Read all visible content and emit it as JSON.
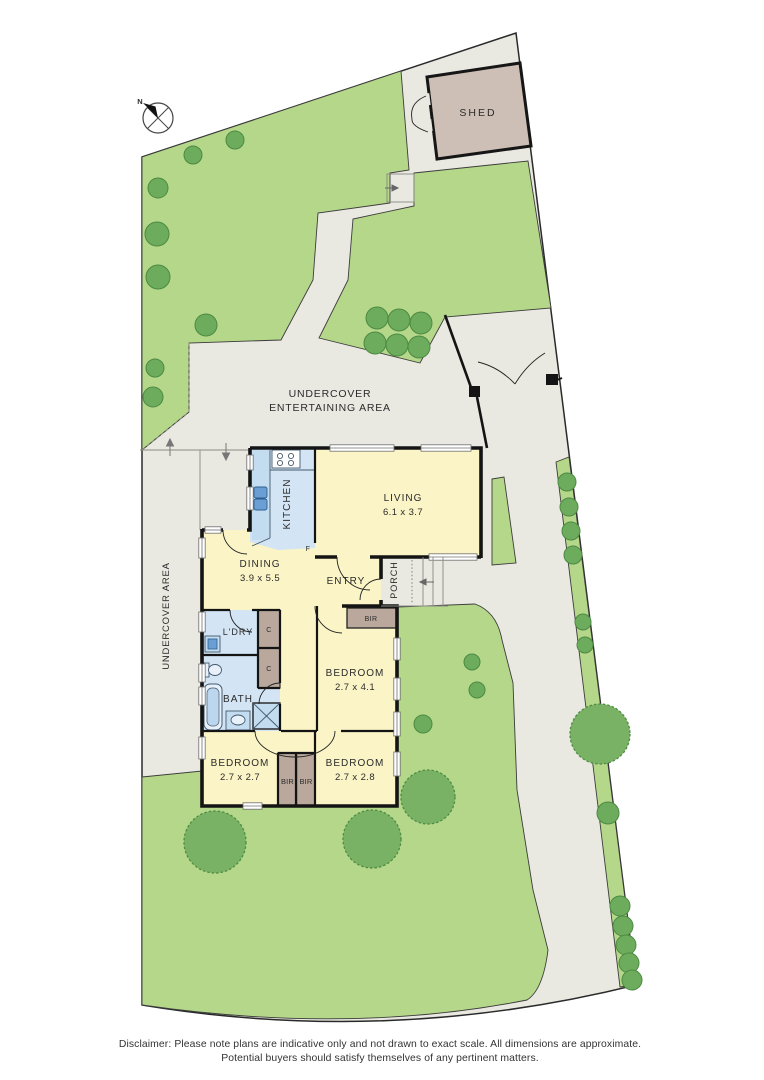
{
  "plan": {
    "compass": {
      "north_label": "N"
    },
    "outdoor": {
      "shed_label": "SHED",
      "entertaining_area_line1": "UNDERCOVER",
      "entertaining_area_line2": "ENTERTAINING AREA",
      "undercover_area_label": "UNDERCOVER AREA",
      "porch_label": "PORCH"
    },
    "rooms": {
      "living": {
        "label": "LIVING",
        "dims": "6.1 x 3.7"
      },
      "dining": {
        "label": "DINING",
        "dims": "3.9 x 5.5"
      },
      "kitchen": {
        "label": "KITCHEN"
      },
      "entry": {
        "label": "ENTRY"
      },
      "bath": {
        "label": "BATH"
      },
      "laundry": {
        "label": "L'DRY"
      },
      "bedroom_main": {
        "label": "BEDROOM",
        "dims": "2.7 x 4.1"
      },
      "bedroom_rear_left": {
        "label": "BEDROOM",
        "dims": "2.7 x 2.7"
      },
      "bedroom_rear_right": {
        "label": "BEDROOM",
        "dims": "2.7 x 2.8"
      }
    },
    "storage": {
      "bir_main": "BIR",
      "bir_left": "BIR",
      "bir_right": "BIR",
      "cupboard_top": "C",
      "cupboard_bottom": "C",
      "fridge": "F"
    },
    "colors": {
      "lawn": "#b4d78a",
      "paving": "#e9e8e1",
      "floor": "#fbf4c6",
      "wet_area": "#d3e5f4",
      "robe": "#b9a89b",
      "shed": "#cdbfb5",
      "wall": "#141414"
    }
  },
  "footer": {
    "disclaimer_line1": "Disclaimer: Please note plans are indicative only and not drawn to exact scale. All dimensions are approximate.",
    "disclaimer_line2": "Potential buyers should satisfy themselves of any pertinent matters."
  }
}
